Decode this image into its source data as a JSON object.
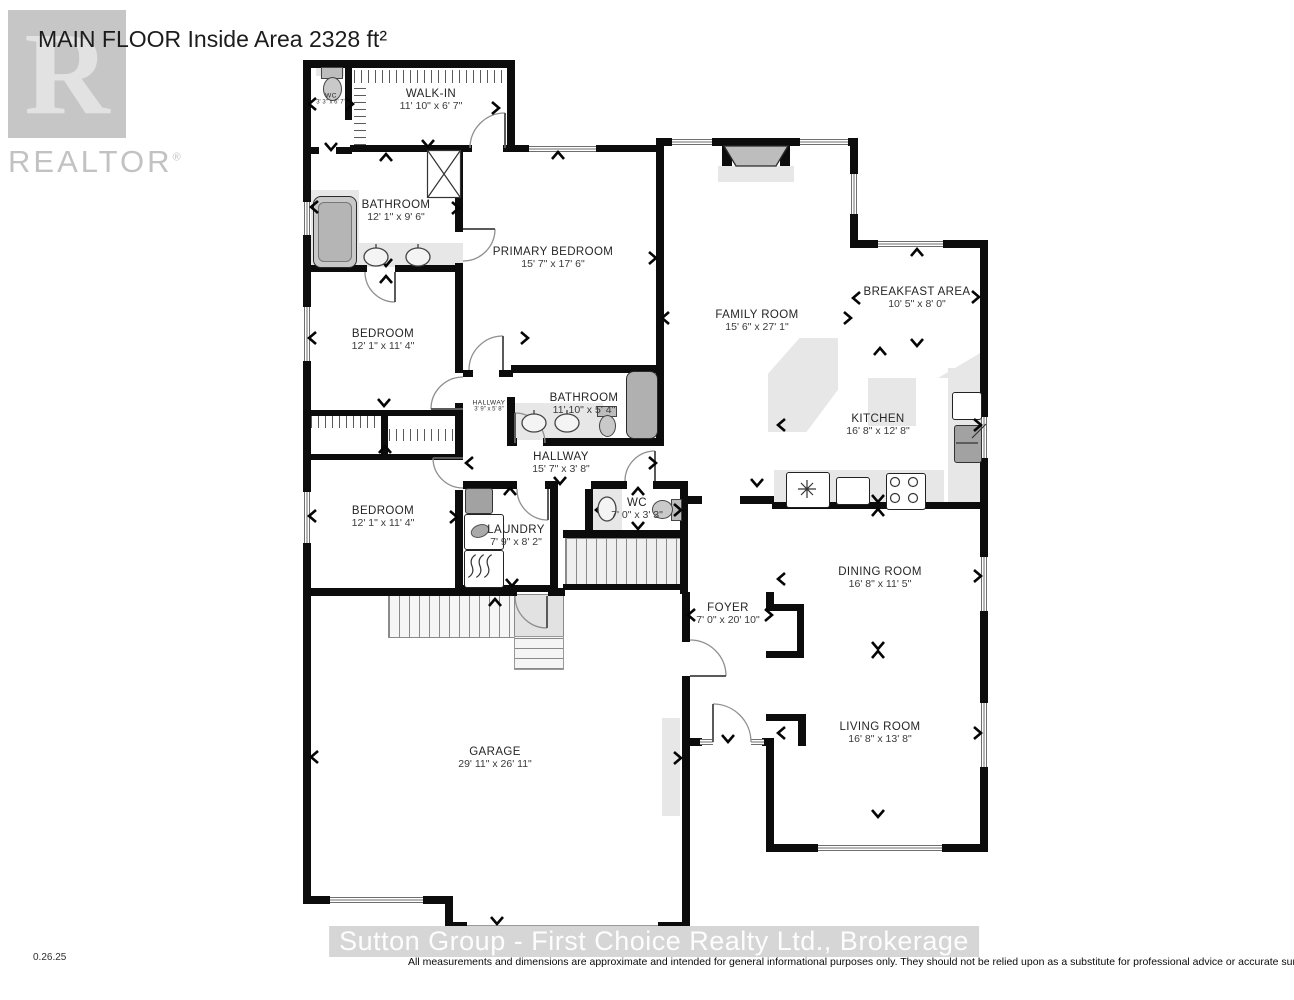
{
  "header": {
    "title": "MAIN FLOOR Inside Area 2328 ft²"
  },
  "branding": {
    "logo_letter": "R",
    "logo_name": "REALTOR",
    "registered_mark": "®"
  },
  "rooms": {
    "wc_upper": {
      "name": "WC",
      "dims": "3' 3\" x 6' 7\""
    },
    "walk_in": {
      "name": "WALK-IN",
      "dims": "11' 10\" x 6' 7\""
    },
    "bathroom_main": {
      "name": "BATHROOM",
      "dims": "12' 1\" x 9' 6\""
    },
    "primary_bedroom": {
      "name": "PRIMARY BEDROOM",
      "dims": "15' 7\" x 17' 6\""
    },
    "bedroom_upper": {
      "name": "BEDROOM",
      "dims": "12' 1\" x 11' 4\""
    },
    "family_room": {
      "name": "FAMILY ROOM",
      "dims": "15' 6\" x 27' 1\""
    },
    "breakfast_area": {
      "name": "BREAKFAST AREA",
      "dims": "10' 5\" x 8' 0\""
    },
    "kitchen": {
      "name": "KITCHEN",
      "dims": "16' 8\" x 12' 8\""
    },
    "hallway_small": {
      "name": "HALLWAY",
      "dims": "3' 9\" x 5' 8\""
    },
    "bathroom_second": {
      "name": "BATHROOM",
      "dims": "11' 10\" x 5' 4\""
    },
    "hallway_main": {
      "name": "HALLWAY",
      "dims": "15' 7\" x 3' 8\""
    },
    "bedroom_lower": {
      "name": "BEDROOM",
      "dims": "12' 1\" x 11' 4\""
    },
    "laundry": {
      "name": "LAUNDRY",
      "dims": "7' 9\" x 8' 2\""
    },
    "wc_main": {
      "name": "WC",
      "dims": "7' 0\" x 3' 3\""
    },
    "dining_room": {
      "name": "DINING ROOM",
      "dims": "16' 8\" x 11' 5\""
    },
    "foyer": {
      "name": "FOYER",
      "dims": "7' 0\" x 20' 10\""
    },
    "living_room": {
      "name": "LIVING ROOM",
      "dims": "16' 8\" x 13' 8\""
    },
    "garage": {
      "name": "GARAGE",
      "dims": "29' 11\" x 26' 11\""
    }
  },
  "footer": {
    "date": "0.26.25",
    "brokerage_watermark": "Sutton Group - First Choice Realty Ltd., Brokerage",
    "disclaimer": "All measurements and dimensions are approximate and intended for general informational purposes only. They should not be relied upon as a substitute for professional advice or accurate surveying."
  },
  "colors": {
    "wall": "#0c0c0c",
    "fixture": "#c9c9c9",
    "light_area": "#e7e7e7",
    "watermark": "#d6d6d6"
  }
}
